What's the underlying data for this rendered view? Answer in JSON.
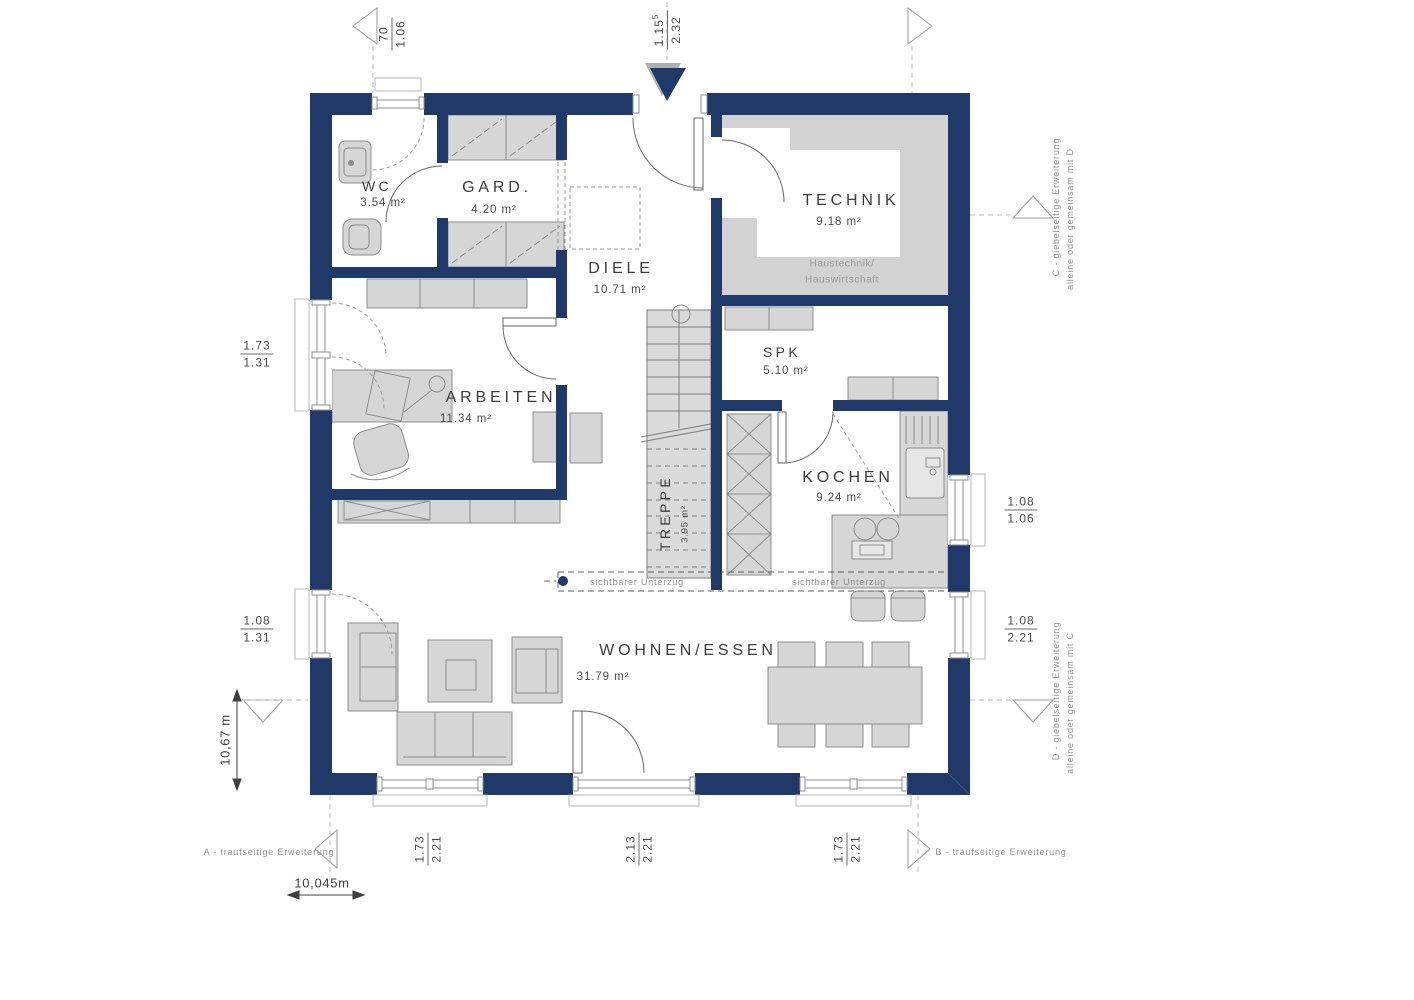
{
  "colors": {
    "wall": "#1f3a68",
    "furniture_fill": "#d6d6d6",
    "furniture_stroke": "#8c8c8c",
    "technik_floor": "#d2d2d2",
    "annotation_gray": "#9a9a9a"
  },
  "rooms": {
    "wc": {
      "name": "WC",
      "area": "3.54 m²"
    },
    "gard": {
      "name": "GARD.",
      "area": "4.20 m²"
    },
    "diele": {
      "name": "DIELE",
      "area": "10.71 m²"
    },
    "technik": {
      "name": "TECHNIK",
      "area": "9.18 m²",
      "note_line1": "Haustechnik/",
      "note_line2": "Hauswirtschaft"
    },
    "spk": {
      "name": "SPK",
      "area": "5.10 m²"
    },
    "arbeiten": {
      "name": "ARBEITEN",
      "area": "11.34 m²"
    },
    "kochen": {
      "name": "KOCHEN",
      "area": "9.24 m²"
    },
    "treppe": {
      "name": "TREPPE",
      "area": "3.95 m²"
    },
    "wohnen_essen": {
      "name": "WOHNEN/ESSEN",
      "area": "31.79 m²"
    }
  },
  "dimensions": {
    "top_left": {
      "num": "70",
      "den": "1.06"
    },
    "top_center": {
      "num": "1.15",
      "num_sup": "5",
      "den": "2.32"
    },
    "left_upper": {
      "num": "1.73",
      "den": "1.31"
    },
    "left_lower": {
      "num": "1.08",
      "den": "1.31"
    },
    "right_upper": {
      "num": "1.08",
      "den": "1.06"
    },
    "right_lower": {
      "num": "1.08",
      "den": "2.21"
    },
    "bottom_left": {
      "num": "1.73",
      "den": "2.21"
    },
    "bottom_center": {
      "num": "2.13",
      "den": "2.21"
    },
    "bottom_right": {
      "num": "1.73",
      "den": "2.21"
    },
    "overall_width": "10,045m",
    "overall_height": "10,67 m"
  },
  "annotations": {
    "a": "A - traufseitige Erweiterung",
    "b": "B - traufseitige Erweiterung",
    "c_line1": "C - giebelseitige Erweiterung",
    "c_line2": "alleine oder gemeinsam mit D",
    "d_line1": "D - giebelseitige Erweiterung",
    "d_line2": "alleine oder gemeinsam mit C",
    "beam_left": "sichtbarer Unterzug",
    "beam_right": "sichtbarer Unterzug"
  }
}
